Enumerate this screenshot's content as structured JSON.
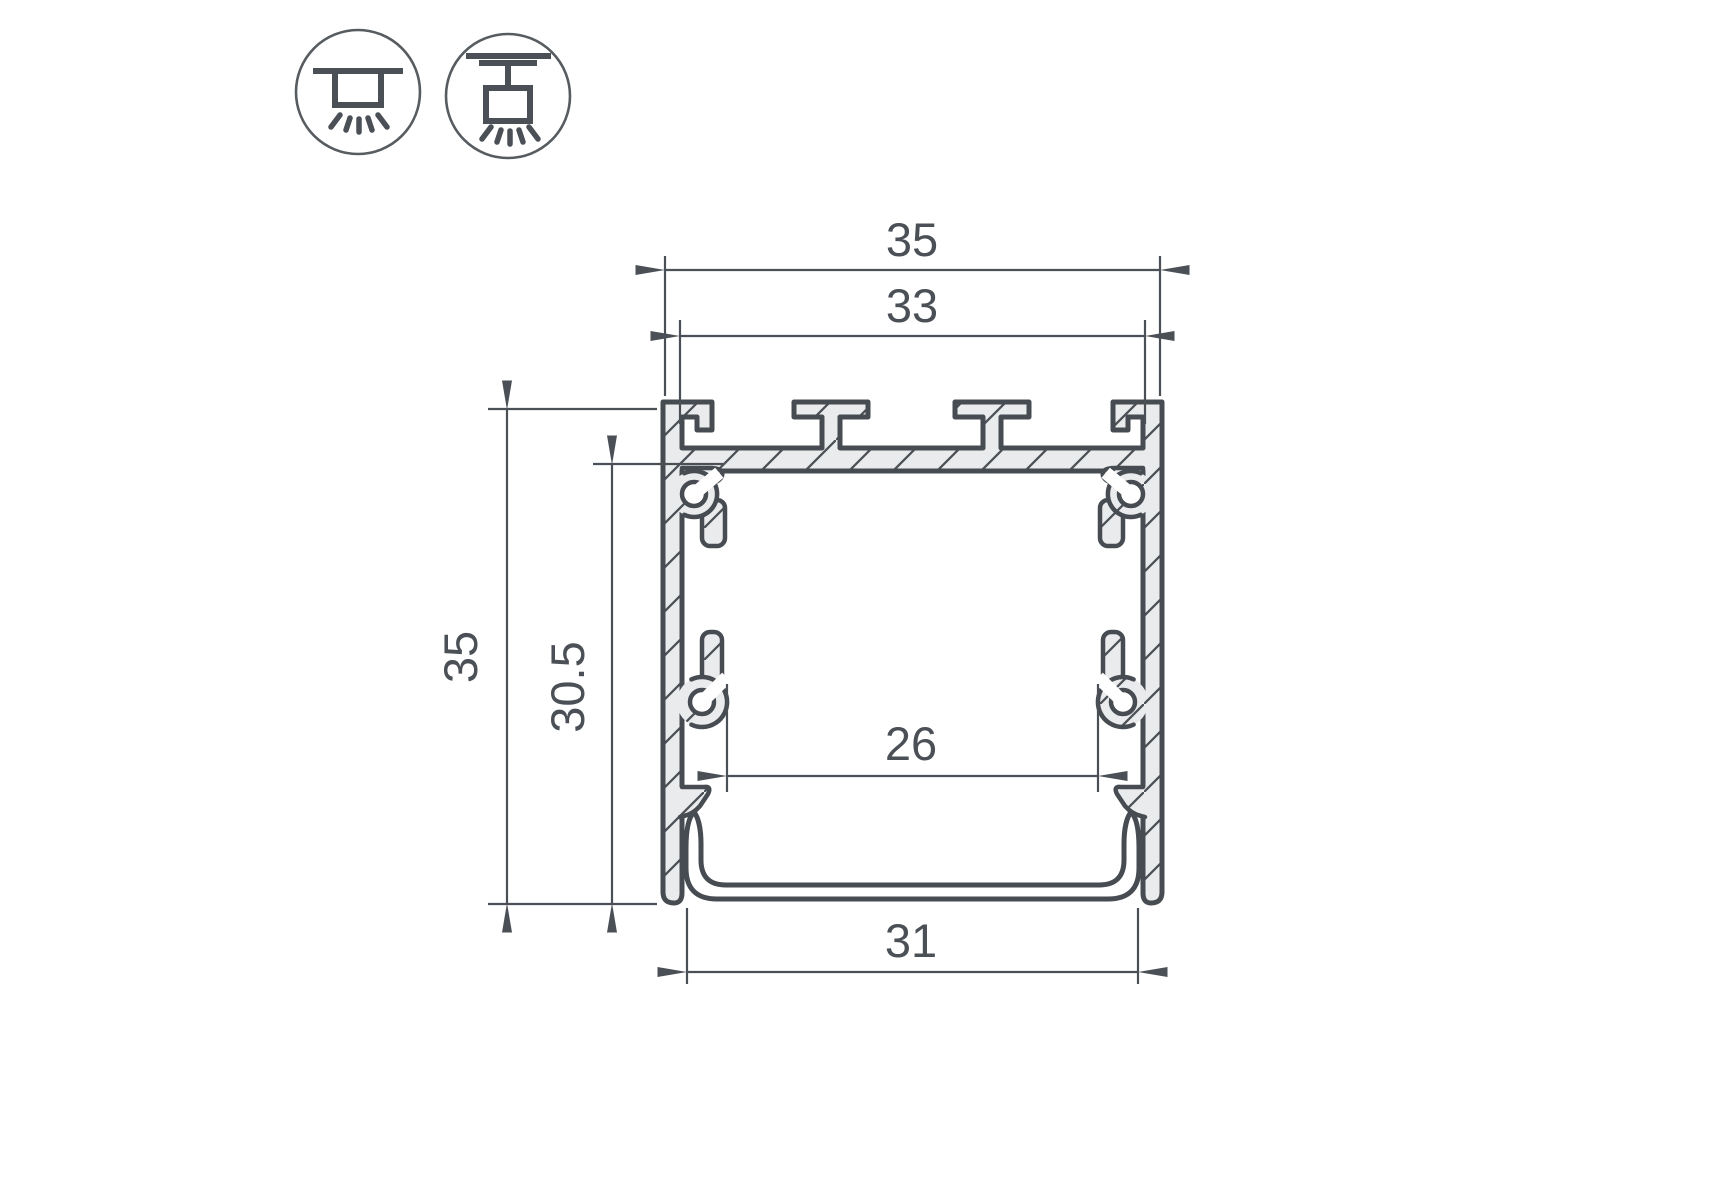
{
  "page": {
    "background": "#ffffff"
  },
  "icons": {
    "left": {
      "name": "surface-mount-ceiling-light"
    },
    "right": {
      "name": "pendant-mount-ceiling-light"
    }
  },
  "drawing": {
    "type": "led-profile-cross-section",
    "dimensions": {
      "outer_width": "35",
      "inner_top_width": "33",
      "outer_height": "35",
      "inner_height": "30.5",
      "inner_width": "26",
      "bottom_width": "31"
    },
    "colors": {
      "outline": "#464c52",
      "dimension": "#4a5056",
      "metal_fill": "#eaebec",
      "hatch_line": "#4b5157",
      "background": "#ffffff"
    }
  }
}
